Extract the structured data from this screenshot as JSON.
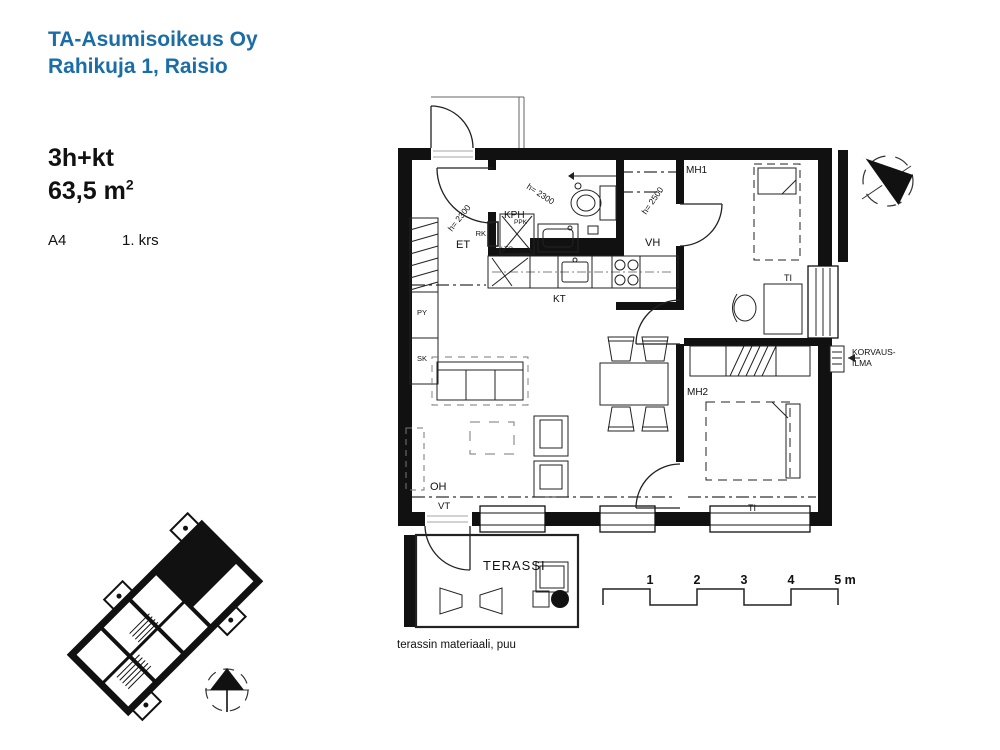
{
  "header": {
    "company": "TA-Asumisoikeus Oy",
    "address": "Rahikuja 1, Raisio",
    "brand_blue": "#1a6da6"
  },
  "apartment": {
    "type": "3h+kt",
    "area": "63,5 m",
    "area_sup": "2",
    "unit_id": "A4",
    "floor": "1. krs"
  },
  "plan": {
    "labels": {
      "et": "ET",
      "kph": "KPH",
      "vh": "VH",
      "mh1": "MH1",
      "mh2": "MH2",
      "kt": "KT",
      "oh": "OH",
      "vt": "VT",
      "ti_mh1": "TI",
      "ti_mh2": "TI",
      "terassi": "TERASSI"
    },
    "fixtures": {
      "rk": "RK",
      "lto": "LTO",
      "ppk": "PPK",
      "py": "PY",
      "sk": "SK"
    },
    "ceiling_heights": {
      "et": "h= 2300",
      "kph": "h= 2300",
      "vh": "h= 2500"
    },
    "vent_label": {
      "line1": "KORVAUS-",
      "line2": "ILMA"
    },
    "terrace_note": "terassin materiaali, puu"
  },
  "scale_bar": {
    "ticks": [
      "1",
      "2",
      "3",
      "4",
      "5 m"
    ]
  },
  "colors": {
    "ink": "#111111",
    "brand_blue": "#1a6da6"
  }
}
